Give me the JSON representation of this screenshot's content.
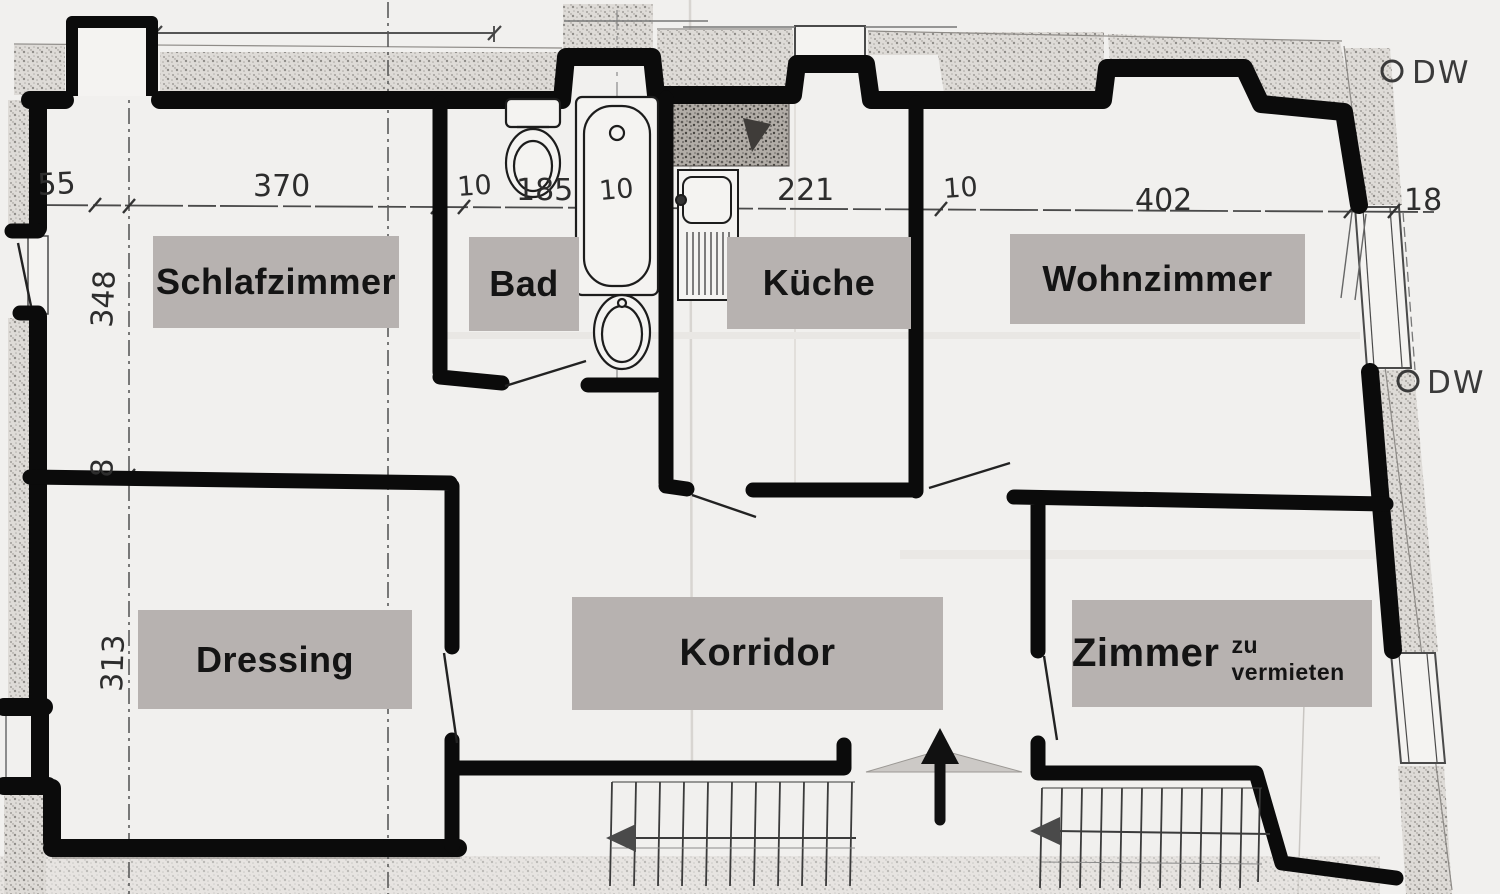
{
  "rooms": [
    {
      "id": "schlafzimmer",
      "name": "Schlafzimmer"
    },
    {
      "id": "bad",
      "name": "Bad"
    },
    {
      "id": "kueche",
      "name": "Küche"
    },
    {
      "id": "wohnzimmer",
      "name": "Wohnzimmer"
    },
    {
      "id": "dressing",
      "name": "Dressing"
    },
    {
      "id": "korridor",
      "name": "Korridor"
    },
    {
      "id": "zimmer",
      "name": "Zimmer",
      "note": "zu vermieten"
    }
  ],
  "dimensions": {
    "top": [
      "55",
      "370",
      "10",
      "185",
      "10",
      "221",
      "10",
      "402",
      "18"
    ],
    "left": [
      "348",
      "8",
      "313"
    ]
  },
  "annotations": {
    "downspout": "DW"
  },
  "colors": {
    "wall": "#0b0b0b",
    "label_bg": "#b7b2b0",
    "paper": "#f1f0ee",
    "hatch": "#dedbd7"
  }
}
